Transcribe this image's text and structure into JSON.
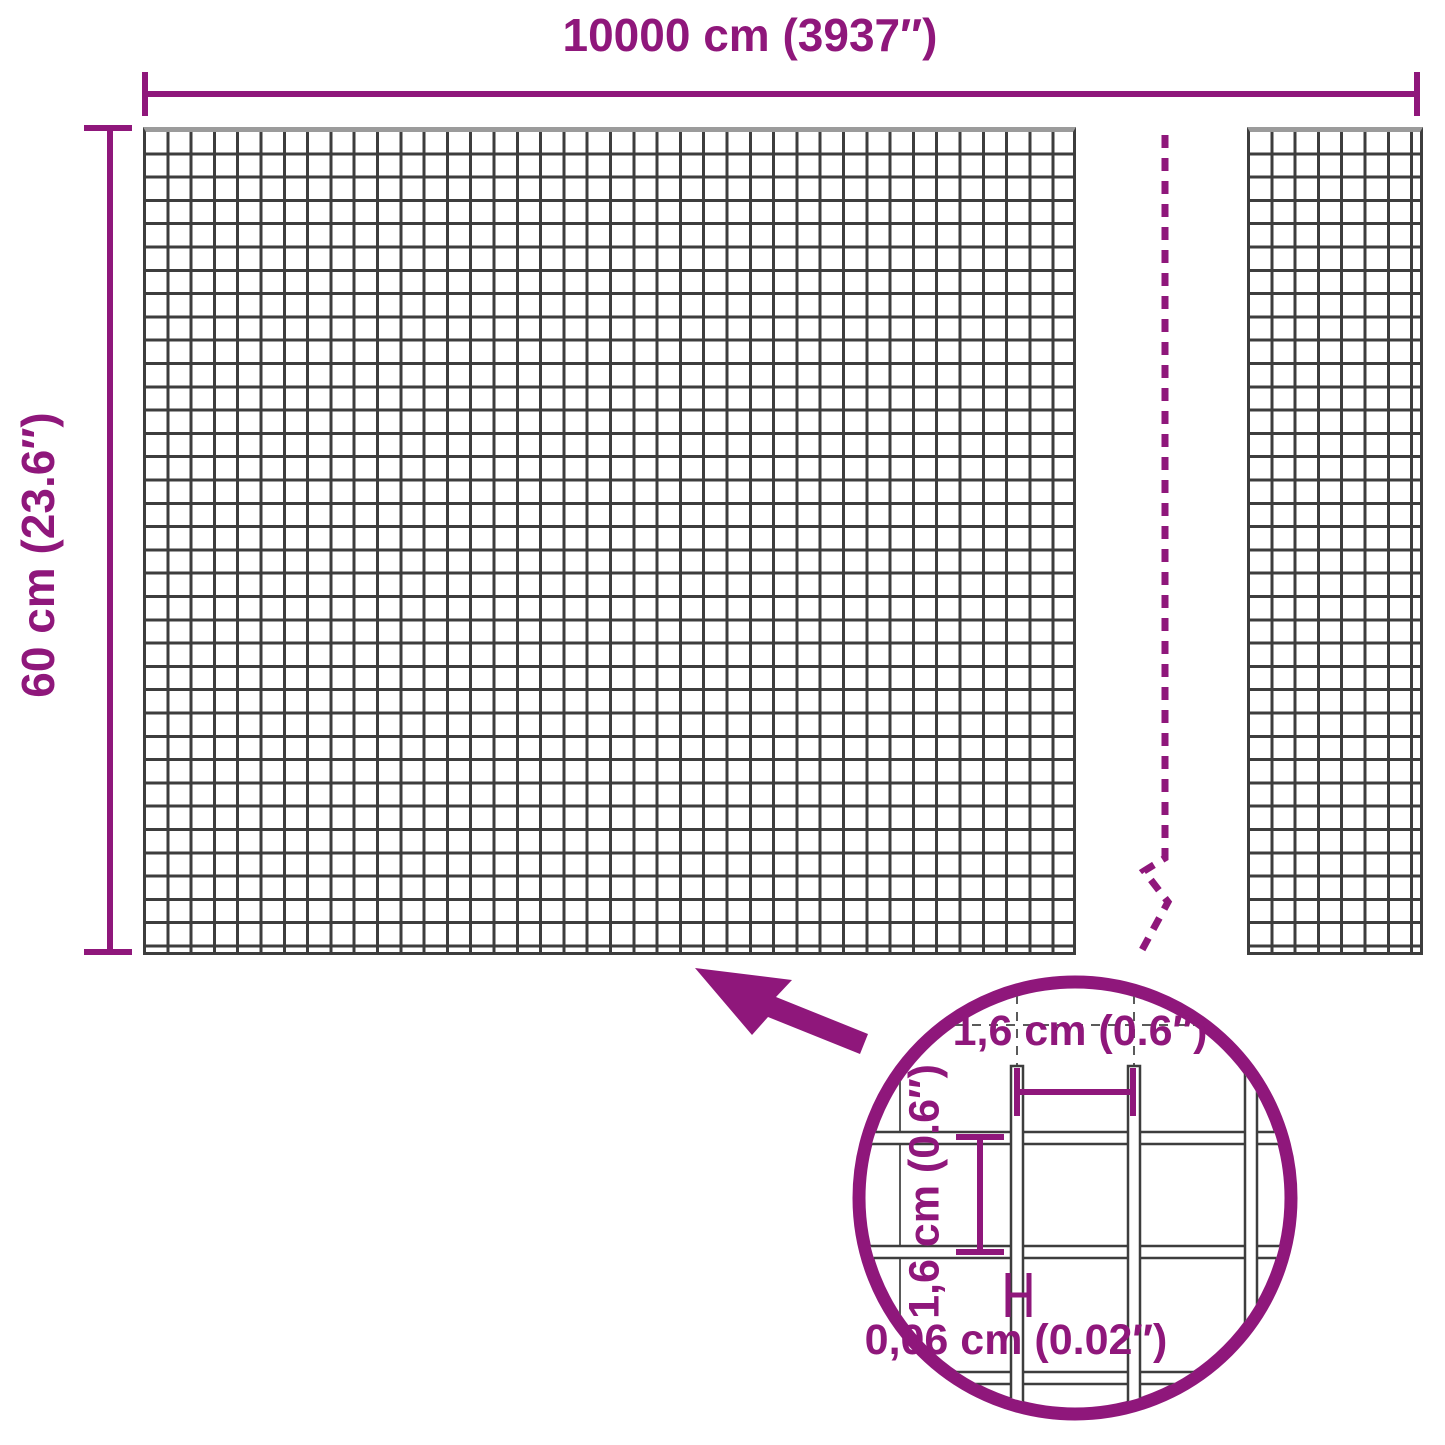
{
  "diagram_title": "Wire mesh roll dimension diagram",
  "colors": {
    "accent_purple": "#8F177B",
    "mesh_line": "#3d3d3d",
    "mesh_top_edge": "#9b9b9b",
    "background": "#ffffff"
  },
  "dimension_labels": {
    "total_width": "10000 cm (3937″)",
    "roll_height": "60 cm (23.6″)"
  },
  "magnifier": {
    "mesh_opening_width": "1,6 cm (0.6″)",
    "mesh_opening_height": "1,6 cm (0.6″)",
    "wire_thickness": "0,06 cm (0.02″)"
  }
}
